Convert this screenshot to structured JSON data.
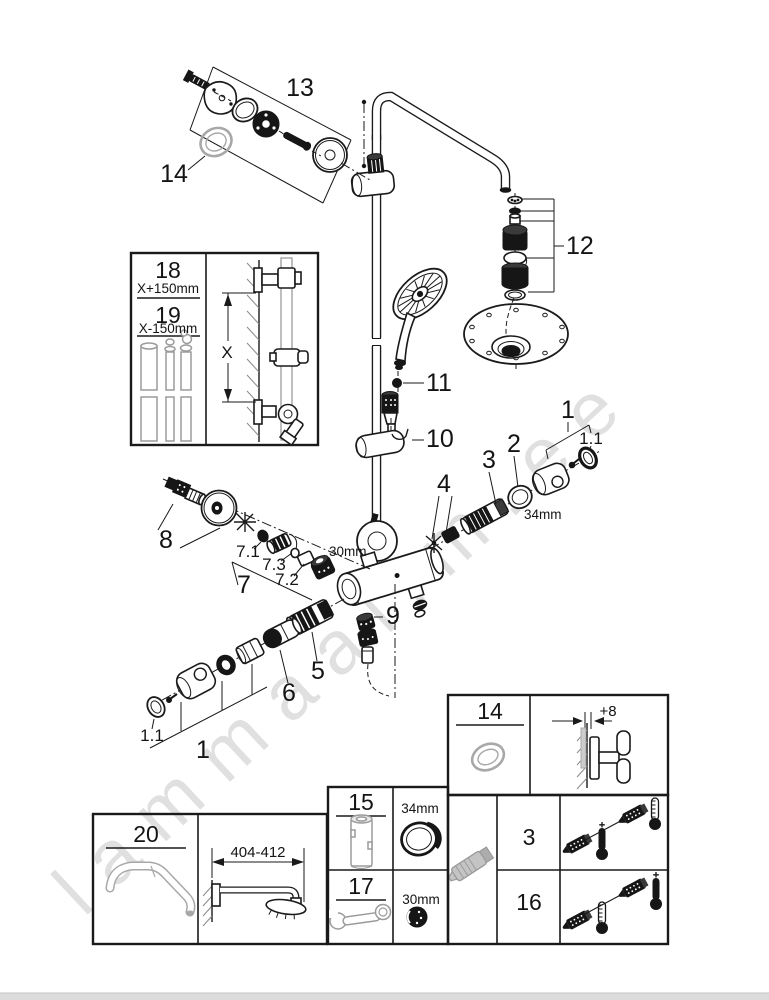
{
  "watermark": "lammaailm.ee",
  "callouts": {
    "c13": "13",
    "c14": "14",
    "c12": "12",
    "c11": "11",
    "c10": "10",
    "c1_right": "1",
    "c1_1_right": "1.1",
    "c2": "2",
    "c2_size": "34mm",
    "c3": "3",
    "c4": "4",
    "c8": "8",
    "c7_1": "7.1",
    "c7_3": "7.3",
    "c7_2": "7.2",
    "c7": "7",
    "c7_size": "30mm",
    "c9": "9",
    "c5": "5",
    "c6": "6",
    "c1_1_left": "1.1",
    "c1_left": "1"
  },
  "inset": {
    "p18": "18",
    "d18": "X+150mm",
    "p19": "19",
    "d19": "X-150mm",
    "x": "X"
  },
  "boxes": {
    "seal": {
      "num": "14",
      "offset": "+8"
    },
    "tools": {
      "rows": [
        {
          "num": "15",
          "size": "34mm"
        },
        {
          "num": "17",
          "size": "30mm"
        }
      ]
    },
    "valves": {
      "rows": [
        {
          "num": "3"
        },
        {
          "num": "16"
        }
      ]
    },
    "arm": {
      "num": "20",
      "range": "404-412"
    }
  }
}
